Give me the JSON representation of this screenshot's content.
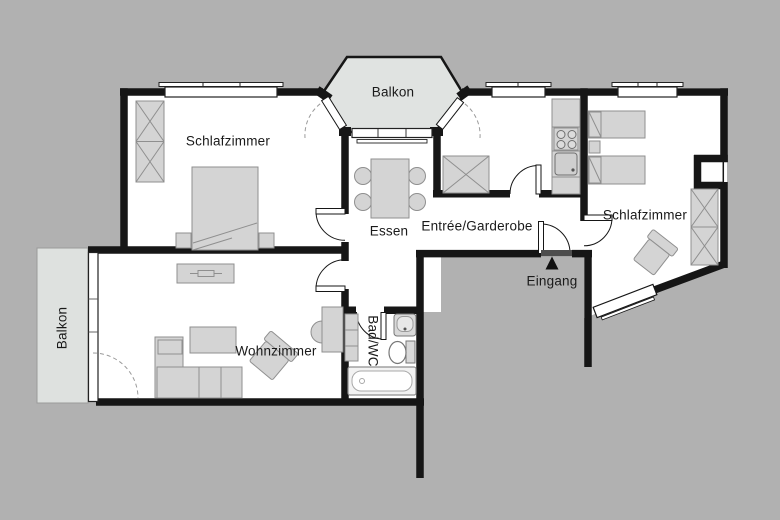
{
  "plan": {
    "labels": {
      "balcony_top": "Balkon",
      "bedroom_left": "Schlafzimmer",
      "bedroom_right": "Schlafzimmer",
      "dining": "Essen",
      "entry_hall": "Entrée/Garderobe",
      "entrance": "Eingang",
      "living_room": "Wohnzimmer",
      "bathroom": "Bad/WC",
      "balcony_left": "Balkon"
    },
    "colors": {
      "background": "#b1b1b1",
      "floor": "#ffffff",
      "wall": "#161616",
      "furniture_fill": "#d4d4d4",
      "furniture_stroke": "#8f8f8f",
      "balcony_fill": "#e0e3e1"
    }
  }
}
